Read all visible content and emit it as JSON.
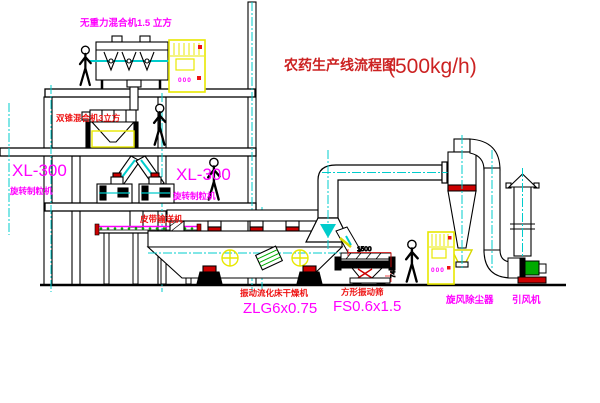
{
  "page": {
    "width": 600,
    "height": 403,
    "background": "#ffffff"
  },
  "title": {
    "name": "农药生产线流程图",
    "capacity": "(500kg/h)",
    "color": "#cc2222"
  },
  "colors": {
    "magenta": "#ff00ff",
    "red": "#ee1111",
    "dark_red": "#cc0000",
    "yellow": "#e8e800",
    "cyan": "#00cccc",
    "green": "#00aa00",
    "black": "#000000"
  },
  "labels": {
    "gravity_mixer": {
      "text": "无重力混合机1.5 立方",
      "color": "#ff00ff"
    },
    "double_cone_mixer": {
      "text": "双锥混合机3立方",
      "color": "#ee1111"
    },
    "granulator_left_model": {
      "text": "XL-300",
      "color": "#ff00ff"
    },
    "granulator_left_name": {
      "text": "旋转制粒机",
      "color": "#ff00ff"
    },
    "granulator_right_model": {
      "text": "XL-300",
      "color": "#ff00ff"
    },
    "granulator_right_name": {
      "text": "旋转制粒机",
      "color": "#ff00ff"
    },
    "belt_conveyor": {
      "text": "皮带输送机",
      "color": "#ee1111"
    },
    "dryer_name": {
      "text": "振动流化床干燥机",
      "color": "#ee1111"
    },
    "dryer_model": {
      "text": "ZLG6x0.75",
      "color": "#ff00ff"
    },
    "sieve_name": {
      "text": "方形振动筛",
      "color": "#ee1111"
    },
    "sieve_model": {
      "text": "FS0.6x1.5",
      "color": "#ff00ff"
    },
    "cyclone": {
      "text": "旋风除尘器",
      "color": "#ff00ff"
    },
    "fan": {
      "text": "引风机",
      "color": "#ff00ff"
    }
  },
  "dimensions": {
    "sieve_width": "1500",
    "sieve_height": "745"
  },
  "cabinets": {
    "display": "000"
  }
}
